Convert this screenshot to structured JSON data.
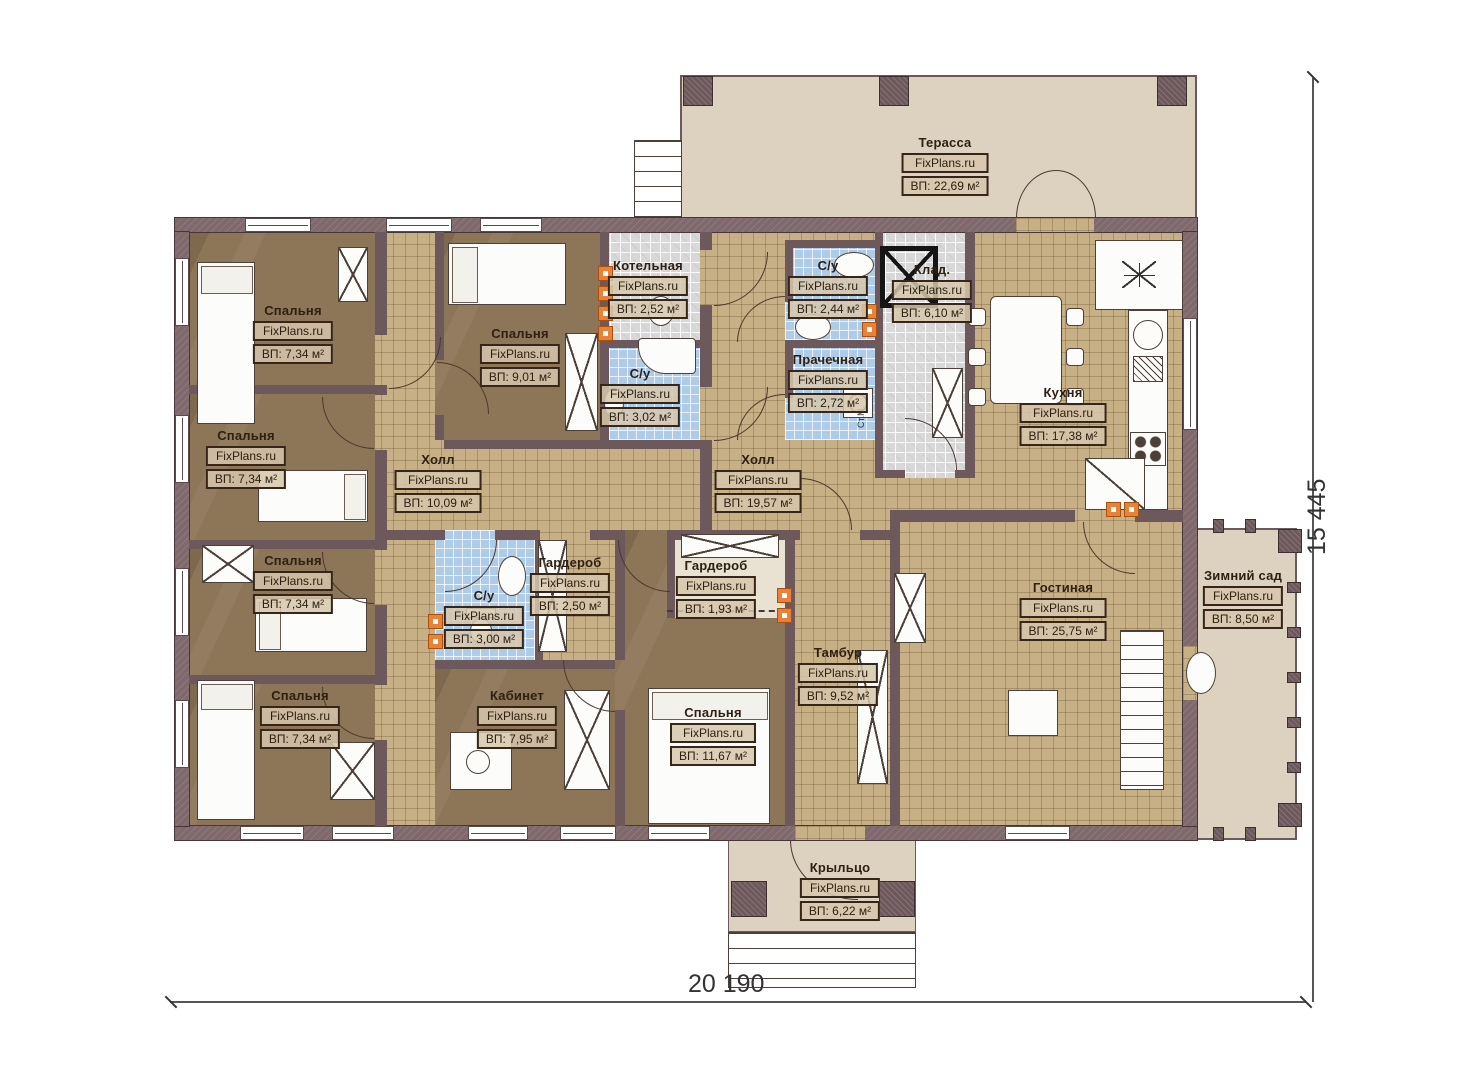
{
  "watermark": "FixPlans.ru",
  "plan": {
    "dimensions": {
      "width_label": "20 190",
      "height_label": "15 445"
    },
    "annotations": {
      "washing_machine": "Ст.М."
    },
    "colors": {
      "wall_exterior": "#7f696d",
      "wall_interior": "#6d585c",
      "floor_wood": "#8d7557",
      "floor_tile_tan": "#c7af86",
      "floor_bath_blue": "#aecbe8",
      "floor_utility_gray": "#d8d8d8",
      "floor_outdoor": "#ddd2bf",
      "vent_accent": "#e8813a",
      "label_border": "#362619"
    }
  },
  "rooms": [
    {
      "name": "Терасса",
      "area": "ВП: 22,69 м²"
    },
    {
      "name": "Спальня",
      "area": "ВП: 7,34 м²"
    },
    {
      "name": "Спальня",
      "area": "ВП: 9,01 м²"
    },
    {
      "name": "Котельная",
      "area": "ВП: 2,52 м²"
    },
    {
      "name": "С/у",
      "area": "ВП: 2,44 м²"
    },
    {
      "name": "Клад.",
      "area": "ВП: 6,10 м²"
    },
    {
      "name": "С/у",
      "area": "ВП: 3,02 м²"
    },
    {
      "name": "Прачечная",
      "area": "ВП: 2,72 м²"
    },
    {
      "name": "Кухня",
      "area": "ВП: 17,38 м²"
    },
    {
      "name": "Спальня",
      "area": "ВП: 7,34 м²"
    },
    {
      "name": "Холл",
      "area": "ВП: 10,09 м²"
    },
    {
      "name": "Холл",
      "area": "ВП: 19,57 м²"
    },
    {
      "name": "Спальня",
      "area": "ВП: 7,34 м²"
    },
    {
      "name": "С/у",
      "area": "ВП: 3,00 м²"
    },
    {
      "name": "Гардероб",
      "area": "ВП: 2,50 м²"
    },
    {
      "name": "Гардероб",
      "area": "ВП: 1,93 м²"
    },
    {
      "name": "Гостиная",
      "area": "ВП: 25,75 м²"
    },
    {
      "name": "Зимний сад",
      "area": "ВП: 8,50 м²"
    },
    {
      "name": "Спальня",
      "area": "ВП: 7,34 м²"
    },
    {
      "name": "Кабинет",
      "area": "ВП: 7,95 м²"
    },
    {
      "name": "Спальня",
      "area": "ВП: 11,67 м²"
    },
    {
      "name": "Тамбур",
      "area": "ВП: 9,52 м²"
    },
    {
      "name": "Крыльцо",
      "area": "ВП: 6,22 м²"
    }
  ]
}
